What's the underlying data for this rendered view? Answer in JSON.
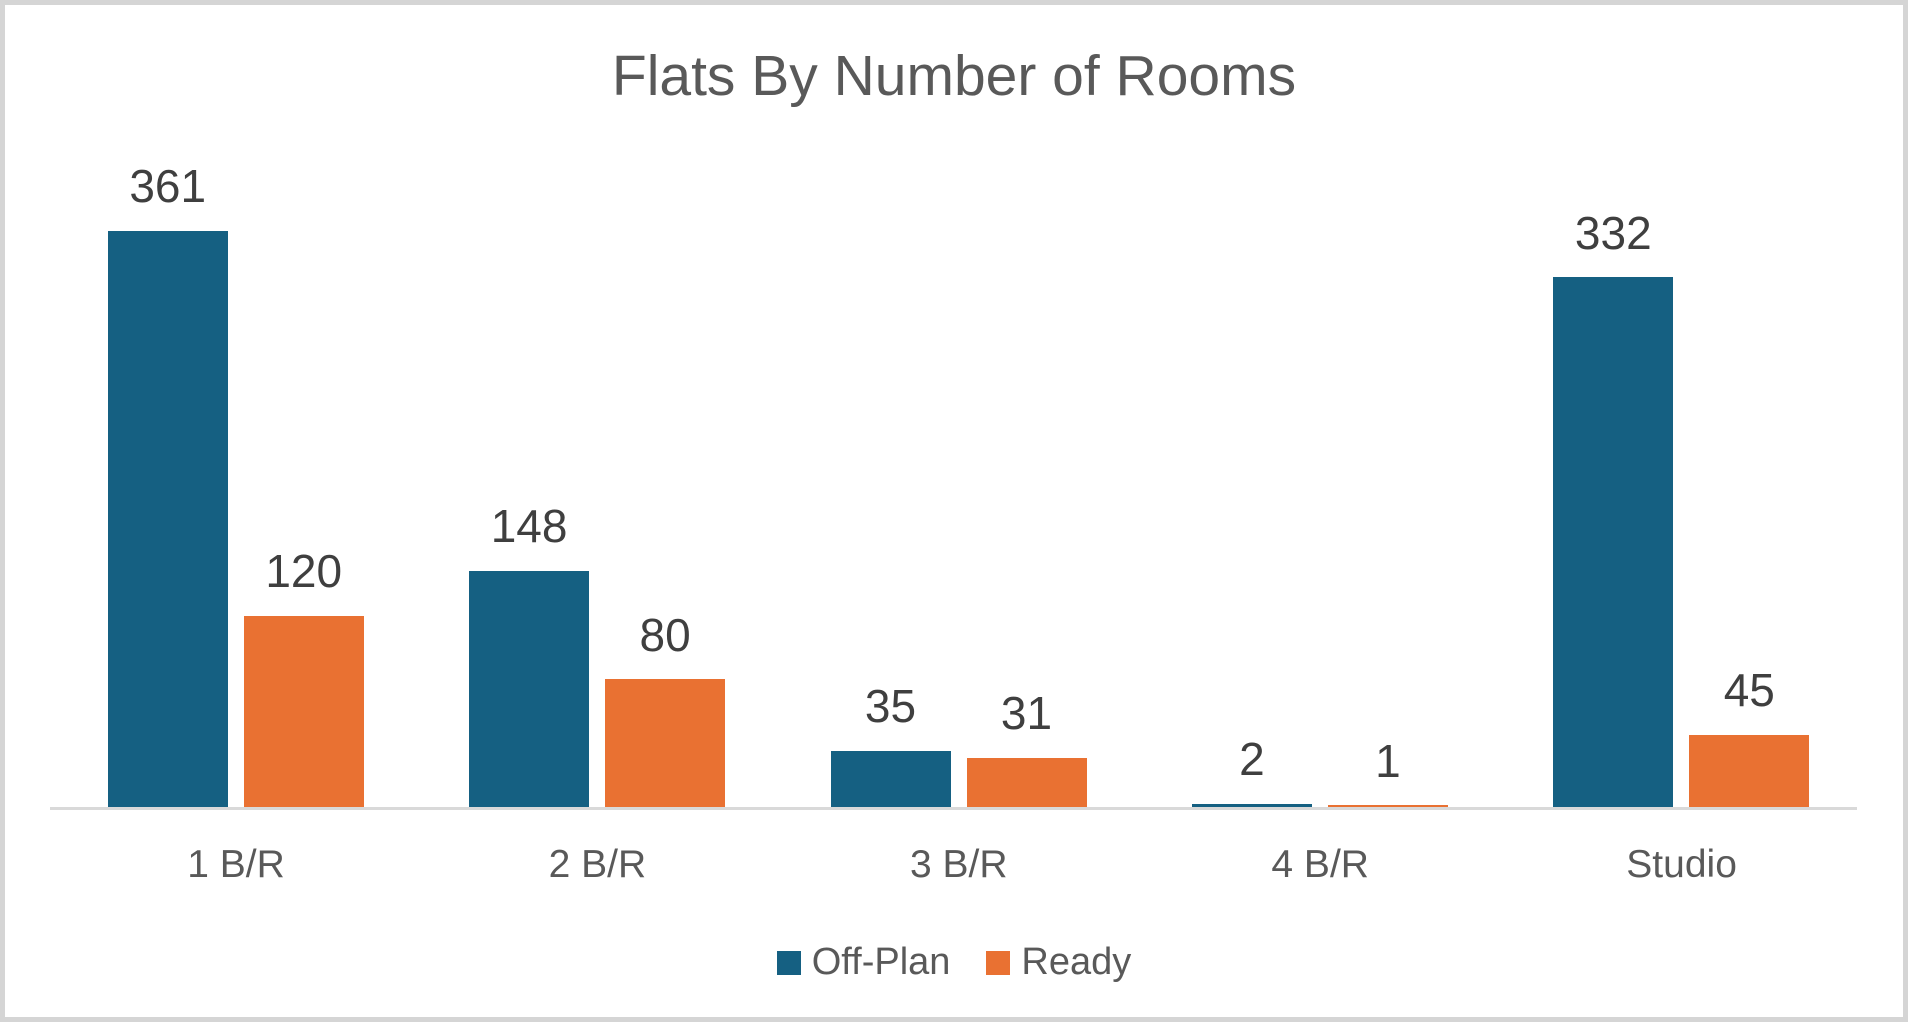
{
  "chart_data": {
    "type": "bar",
    "title": "Flats By Number of Rooms",
    "categories": [
      "1 B/R",
      "2 B/R",
      "3 B/R",
      "4 B/R",
      "Studio"
    ],
    "series": [
      {
        "name": "Off-Plan",
        "color": "#156082",
        "values": [
          361,
          148,
          35,
          2,
          332
        ]
      },
      {
        "name": "Ready",
        "color": "#E97132",
        "values": [
          120,
          80,
          31,
          1,
          45
        ]
      }
    ],
    "xlabel": "",
    "ylabel": "",
    "ylim": [
      0,
      400
    ],
    "grid": false,
    "legend_position": "bottom",
    "data_labels": true
  },
  "colors": {
    "off_plan": "#156082",
    "ready": "#E97132",
    "title_text": "#595959",
    "axis_label_text": "#595959",
    "data_label_text": "#3F3F3F",
    "legend_text": "#595959",
    "axis_line": "#D9D9D9",
    "frame_border": "#D5D5D5",
    "background": "#FFFFFF"
  }
}
